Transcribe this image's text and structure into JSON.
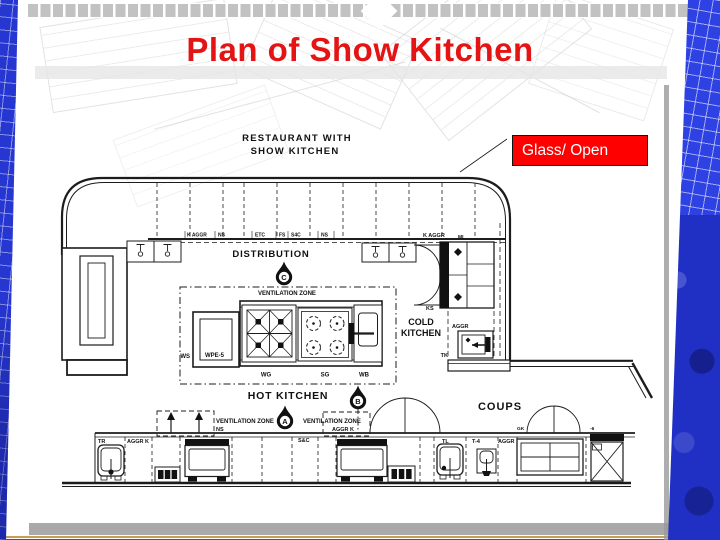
{
  "slide": {
    "title": "Plan of Show Kitchen",
    "callout": "Glass/ Open",
    "colors": {
      "title_red": "#e41414",
      "callout_bg": "#ff0000",
      "callout_text": "#ffffff",
      "callout_border": "#111111",
      "edge_blue": "#2636d0",
      "checker_gray": "#c2c2c2",
      "footer_bar_gray": "#a9a9a9",
      "footer_line_tan": "#c79e56",
      "drawing_ink": "#1c1c1c"
    }
  },
  "plan": {
    "heading1": "RESTAURANT WITH",
    "heading2": "SHOW KITCHEN",
    "distribution": "DISTRIBUTION",
    "hot_kitchen": "HOT KITCHEN",
    "cold_kitchen1": "COLD",
    "cold_kitchen2": "KITCHEN",
    "coups": "COUPS",
    "ventilation_zone": "VENTILATION ZONE",
    "markers": {
      "a": "A",
      "b": "B",
      "c": "C"
    },
    "top_labels": {
      "k_aggr": "K AGGR",
      "ns": "NS",
      "etc": "ETC",
      "fs": "FS",
      "s4c": "S4C",
      "ns2": "NS"
    },
    "cold_labels": {
      "k_aggr": "K AGGR",
      "ml": "ML",
      "ks": "KS",
      "aggr": "AGGR",
      "tk": "TK"
    },
    "island_labels": {
      "ws": "WS",
      "wpe5": "WPE-5",
      "wg": "WG",
      "sg": "SG",
      "wb": "WB"
    },
    "bottom_labels": {
      "tr": "TR",
      "aggr_k": "AGGR K",
      "ns": "NS",
      "sc": "S&C",
      "aggr_k2": "AGGR K",
      "tl": "TL",
      "t4": "T-4",
      "aggr": "AGGR",
      "gk": "GK",
      "minus6": "-6"
    }
  }
}
